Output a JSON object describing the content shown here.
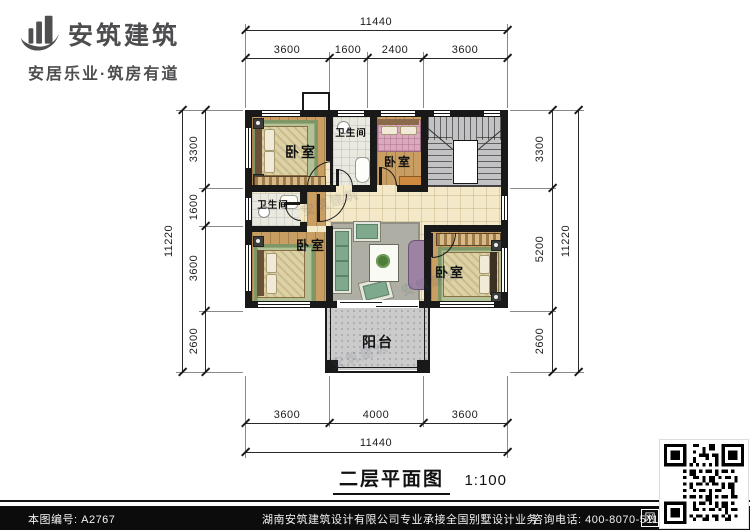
{
  "brand": {
    "name": "安筑建筑",
    "tagline": "安居乐业·筑房有道"
  },
  "plan": {
    "rooms": [
      {
        "id": "bedroom-top-left",
        "label": "卧室"
      },
      {
        "id": "bathroom-top",
        "label": "卫生间"
      },
      {
        "id": "bedroom-top-middle",
        "label": "卧室"
      },
      {
        "id": "bathroom-middle-left",
        "label": "卫生间"
      },
      {
        "id": "bedroom-bottom-left",
        "label": "卧室"
      },
      {
        "id": "bedroom-bottom-right",
        "label": "卧室"
      },
      {
        "id": "balcony",
        "label": "阳台"
      }
    ],
    "dims": {
      "top_overall": "11440",
      "top_segments": [
        "3600",
        "1600",
        "2400",
        "3600"
      ],
      "bottom_segments": [
        "3600",
        "4000",
        "3600"
      ],
      "bottom_overall": "11440",
      "left_overall": "11220",
      "left_segments": [
        "3300",
        "1600",
        "3600",
        "2600"
      ],
      "right_segments": [
        "3300",
        "5200",
        "2600"
      ],
      "right_overall": "11220"
    }
  },
  "caption": {
    "title": "二层平面图",
    "scale": "1:100"
  },
  "footer": {
    "number": "本图编号: A2767",
    "company": "湖南安筑建筑设计有限公司",
    "service": "专业承接全国别墅设计业务",
    "phone": "咨询电话: 400-8070-511",
    "web_mark": "网"
  },
  "colors": {
    "wall": "#191919",
    "wood_floor": "#c89e63",
    "hall_tile": "#f3e9c8",
    "accent_text": "#4d4d4f"
  }
}
